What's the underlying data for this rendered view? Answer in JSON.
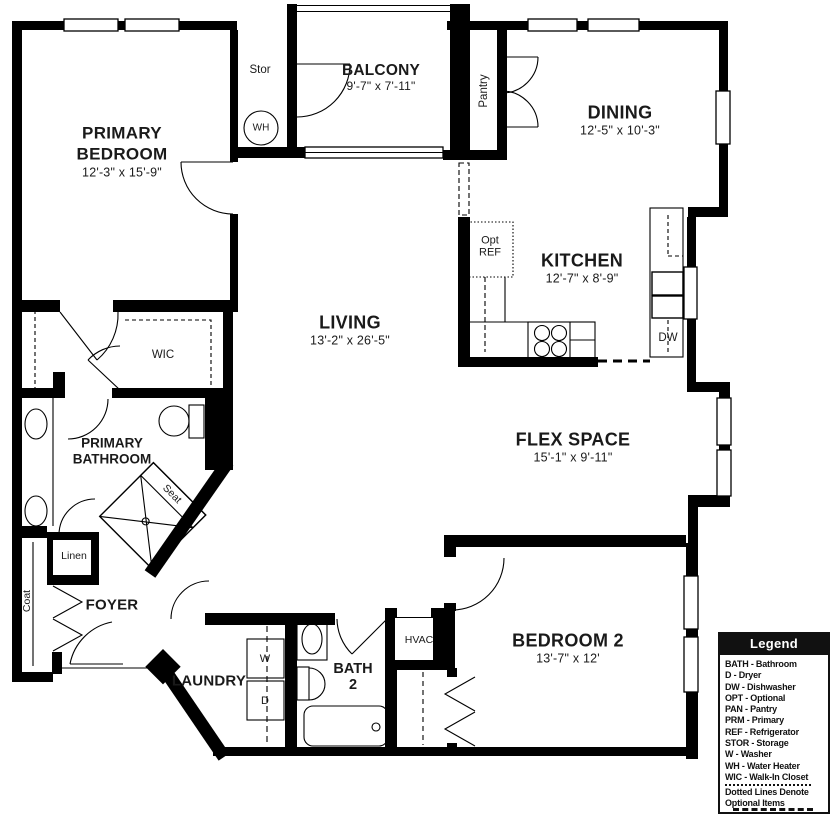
{
  "rooms": {
    "primary_bedroom": {
      "line1": "PRIMARY",
      "line2": "BEDROOM",
      "dims": "12'-3\" x 15'-9\""
    },
    "balcony": {
      "line1": "BALCONY",
      "dims": "9'-7\" x 7'-11\""
    },
    "dining": {
      "line1": "DINING",
      "dims": "12'-5\" x 10'-3\""
    },
    "kitchen": {
      "line1": "KITCHEN",
      "dims": "12'-7\" x 8'-9\""
    },
    "living": {
      "line1": "LIVING",
      "dims": "13'-2\" x 26'-5\""
    },
    "flex_space": {
      "line1": "FLEX SPACE",
      "dims": "15'-1\" x 9'-11\""
    },
    "bedroom_2": {
      "line1": "BEDROOM 2",
      "dims": "13'-7\" x 12'"
    },
    "primary_bathroom": {
      "line1": "PRIMARY",
      "line2": "BATHROOM"
    },
    "foyer": {
      "line1": "FOYER"
    },
    "laundry": {
      "line1": "LAUNDRY"
    },
    "bath_2": {
      "line1": "BATH",
      "line2": "2"
    }
  },
  "fixtures": {
    "stor": "Stor",
    "wh": "WH",
    "pantry": "Pantry",
    "opt": "Opt",
    "ref": "REF",
    "wic": "WIC",
    "seat": "Seat",
    "linen": "Linen",
    "coat": "Coat",
    "washer": "W",
    "dryer": "D",
    "hvac": "HVAC",
    "dw": "DW"
  },
  "legend": {
    "title": "Legend",
    "items": [
      "BATH - Bathroom",
      "D - Dryer",
      "DW - Dishwasher",
      "OPT - Optional",
      "PAN - Pantry",
      "PRM - Primary",
      "REF - Refrigerator",
      "STOR - Storage",
      "W - Washer",
      "WH - Water Heater",
      "WIC - Walk-In Closet"
    ],
    "note1": "Dotted Lines Denote",
    "note2": "Optional Items"
  },
  "colors": {
    "wall": "#000000",
    "background": "#ffffff"
  }
}
